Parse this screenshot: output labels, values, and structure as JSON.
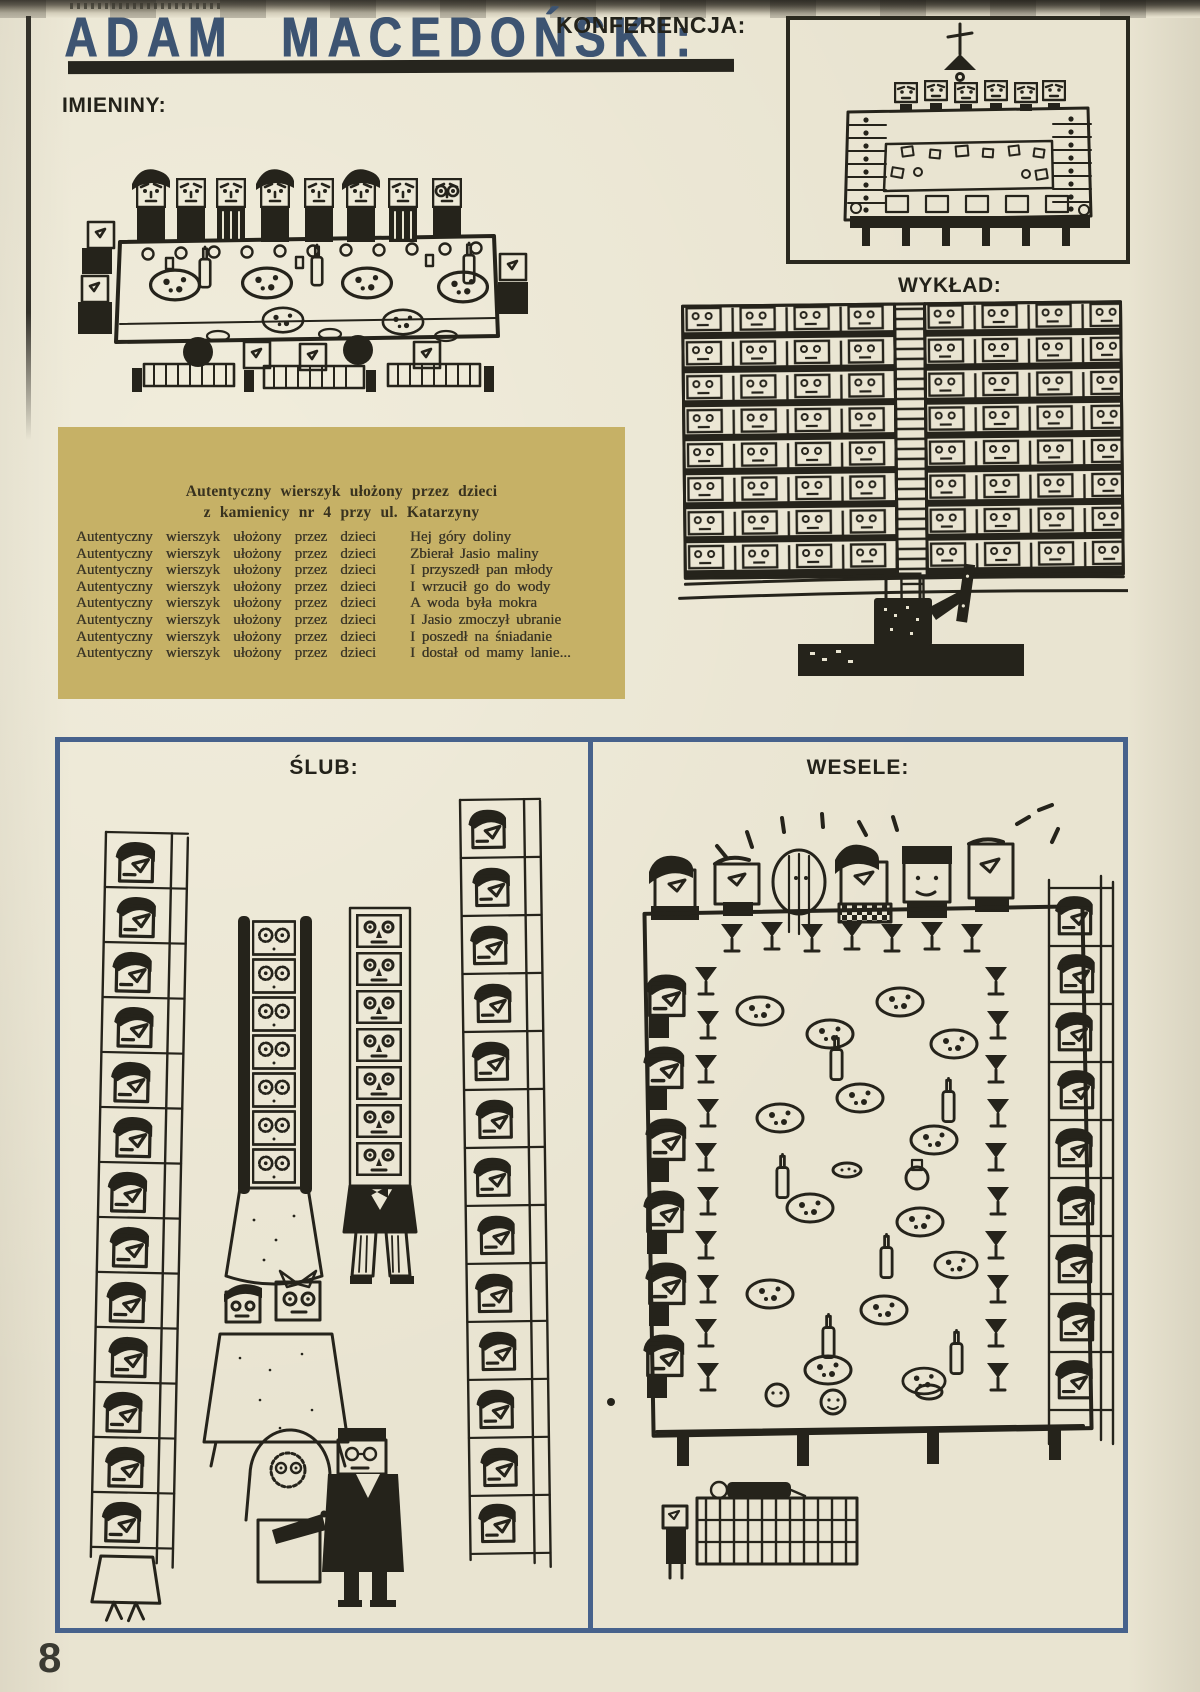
{
  "page": {
    "author_heading": "ADAM MACEDOŃSKI:",
    "page_number": "8"
  },
  "sections": {
    "imieniny_label": "IMIENINY:",
    "konferencja_label": "KONFERENCJA:",
    "wyklad_label": "WYKŁAD:",
    "slub_label": "ŚLUB:",
    "wesele_label": "WESELE:"
  },
  "poem": {
    "heading_line1": "Autentyczny wierszyk ułożony przez dzieci",
    "heading_line2": "z kamienicy nr 4 przy ul. Katarzyny",
    "left_column": [
      "Autentyczny wierszyk ułożony przez dzieci",
      "Autentyczny wierszyk ułożony przez dzieci",
      "Autentyczny wierszyk ułożony przez dzieci",
      "Autentyczny wierszyk ułożony przez dzieci",
      "Autentyczny wierszyk ułożony przez dzieci",
      "Autentyczny wierszyk ułożony przez dzieci",
      "Autentyczny wierszyk ułożony przez dzieci",
      "Autentyczny wierszyk ułożony przez dzieci"
    ],
    "right_column": [
      "Hej góry doliny",
      "Zbierał Jasio maliny",
      "I przyszedł pan młody",
      "I wrzucił go do wody",
      "A woda była mokra",
      "I Jasio zmoczył ubranie",
      "I poszedł na śniadanie",
      "I dostał od mamy lanie..."
    ]
  },
  "colors": {
    "paper": "#e9e4d1",
    "poem_box": "#c6b166",
    "panel_border": "#47628c",
    "title": "#3d5472",
    "ink": "#25231b"
  }
}
